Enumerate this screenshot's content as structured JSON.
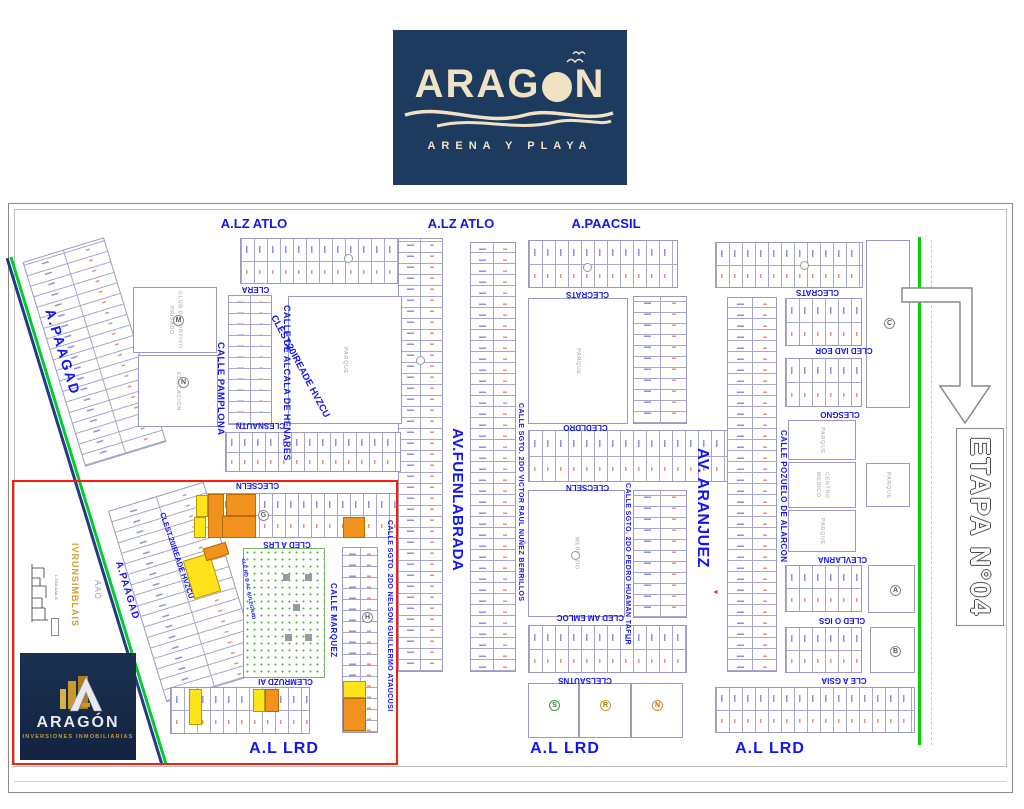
{
  "header_logo": {
    "title": "ARAGÓN",
    "title_pre": "ARAG",
    "title_post": "N",
    "tagline": "ARENA Y PLAYA"
  },
  "corner_logo": {
    "title": "ARAGÓN",
    "tagline": "INVERSIONES INMOBILIARIAS"
  },
  "stage": {
    "label": "ETAPA N°04"
  },
  "avenues": {
    "alz_atlo": "A.LZ ATLO",
    "paacsil": "A.PAACSIL",
    "fuenlabrada": "AV.FUENLABRADA",
    "aranjuez": "AV. ARANJUEZ",
    "paagad": "A.PAAGAD",
    "al_lrd": "A.L LRD"
  },
  "streets": {
    "pamplona": "CALLE PAMPLONA",
    "alcala": "CALLE DE ALCALA DE HENARES",
    "clest": "CLEST.20IREADE HVZCU",
    "victor": "CALLE SGTO. 2DO VICTOR RAUL NUÑEZ BERRILLOS",
    "pedro": "CALLE SGTO. 2DO PEDRO HUAMAN TAFUR",
    "nelson": "CALLE SGTO. 2DO NELSON GUILLERMO ATAUCUSI",
    "pozuelo": "CALLE POZUELO DE ALARCON",
    "marquez": "CALLE MARQUEZ",
    "clera": "CLERA",
    "clesnautn": "CLESNAUTN",
    "clecrats": "CLECRATS",
    "cledldro": "CLEDLDRO",
    "clecseln": "CLECSELN",
    "cled_am_emloc": "CLED AM EMLOC",
    "clelsautns": "CLELSAUTNS",
    "cled_iad_eor": "CLED IAD EOR",
    "clesgno": "CLESGNO",
    "clevlarna": "CLEVLARNA",
    "cled_o_igs": "CLED O IGS",
    "cle_a_gsia": "CLE A GSIA",
    "cled_a_lrs": "CLED A LRS",
    "clemruzd_ai": "CLEMRUZD AI",
    "aulegrad": "CLE.RD D AC AULEGRAD"
  },
  "blocks": {
    "club": "CLUB DEPORTIVO PRIVADO",
    "educacion": "EDUCACIÓN",
    "parque": "PARQUE",
    "mercado": "MERCADO",
    "centro_medico": "CENTRO MEDICO"
  },
  "badges": {
    "m": "M",
    "n": "N",
    "c": "C",
    "a": "A",
    "b": "B",
    "s": "S",
    "r": "R",
    "n2": "N",
    "h": "H",
    "g": "G"
  },
  "margin_notes": {
    "gold": "IVRUNSIMBLAIS",
    "gray": "AAÓ",
    "small": "L.TGD AAA G"
  },
  "colors": {
    "navy": "#1d3b5f",
    "cream": "#f2e2c4",
    "label_blue": "#1414ee",
    "highlight_red": "#ff1a0e",
    "stage_green": "#00d300",
    "lot_orange": "#f2921e",
    "lot_yellow": "#ffe41c",
    "gold": "#cfa12f"
  }
}
